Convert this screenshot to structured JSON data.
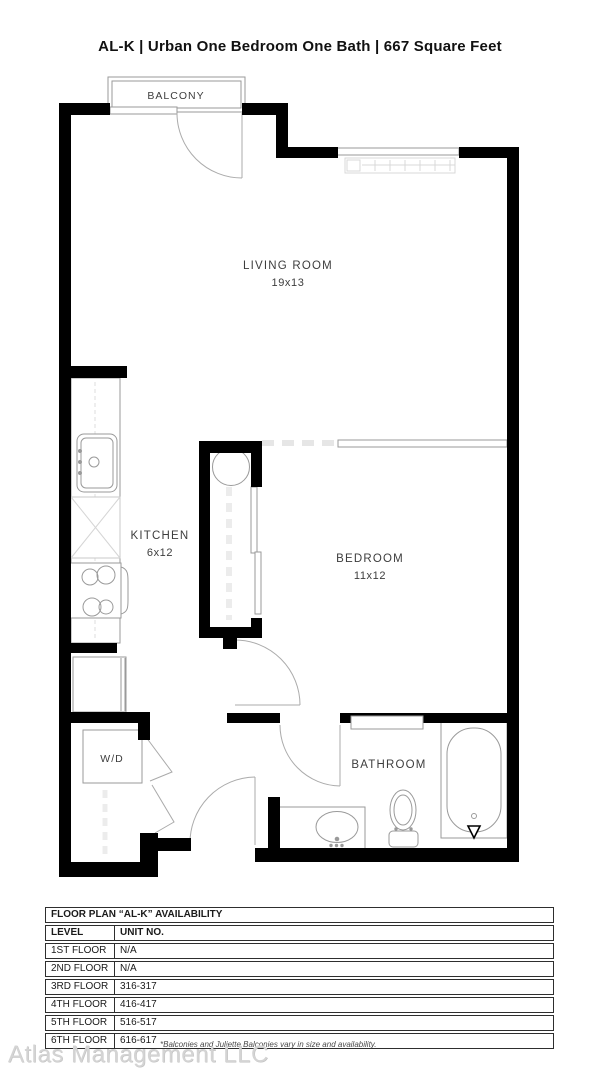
{
  "title": "AL-K | Urban One Bedroom One Bath | 667 Square Feet",
  "floorplan": {
    "rooms": {
      "balcony": {
        "label": "BALCONY"
      },
      "living": {
        "label": "LIVING ROOM",
        "dims": "19x13"
      },
      "kitchen": {
        "label": "KITCHEN",
        "dims": "6x12"
      },
      "bedroom": {
        "label": "BEDROOM",
        "dims": "11x12"
      },
      "bathroom": {
        "label": "BATHROOM"
      },
      "washer_dryer": {
        "label": "W/D"
      }
    }
  },
  "availability_table": {
    "title": "FLOOR PLAN “AL-K” AVAILABILITY",
    "columns": [
      "LEVEL",
      "UNIT NO."
    ],
    "rows": [
      {
        "level": "1ST FLOOR",
        "unit": "N/A"
      },
      {
        "level": "2ND FLOOR",
        "unit": "N/A"
      },
      {
        "level": "3RD FLOOR",
        "unit": "316-317"
      },
      {
        "level": "4TH FLOOR",
        "unit": "416-417"
      },
      {
        "level": "5TH FLOOR",
        "unit": "516-517"
      },
      {
        "level": "6TH FLOOR",
        "unit": "616-617"
      }
    ]
  },
  "footer": {
    "note": "*Balconies and Juliette Balconies vary in size and availability.",
    "watermark": "Atlas Management LLC"
  },
  "colors": {
    "wall": "#000000",
    "thin_line": "#9a9a9a",
    "light_line": "#dcdcdc",
    "text": "#3d3d3d"
  }
}
